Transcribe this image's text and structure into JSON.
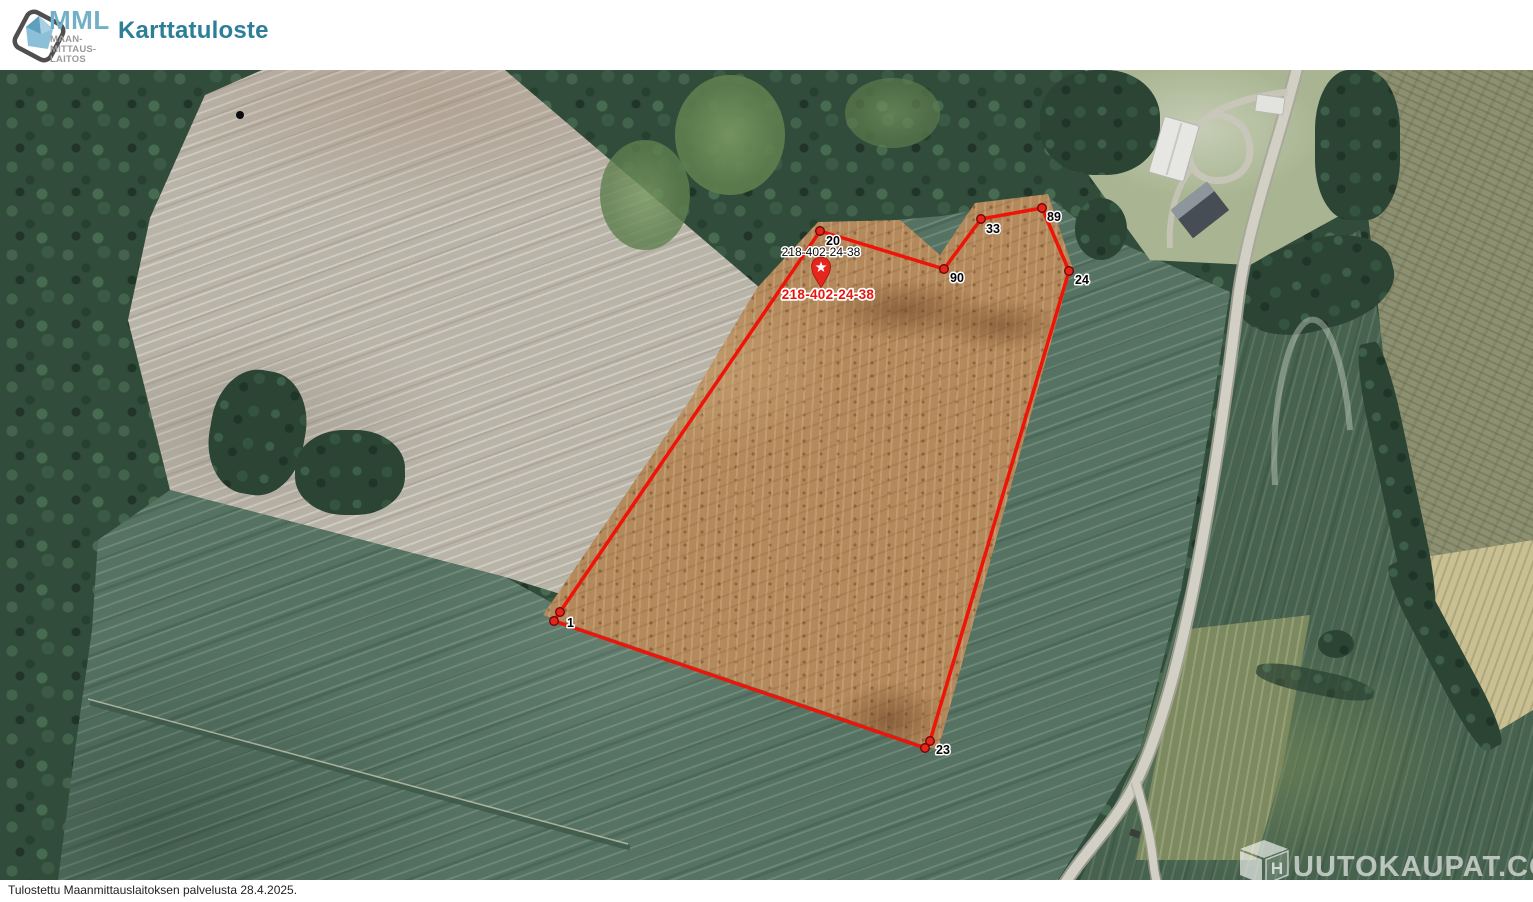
{
  "header": {
    "logo_abbr": "MML",
    "logo_lines": [
      "MAAN-",
      "MITTAUS-",
      "LAITOS"
    ],
    "title": "Karttatuloste"
  },
  "map": {
    "parcel": {
      "id_label_black": "218-402-24-38",
      "id_label_red": "218-402-24-38",
      "marker_icon": "star-pin"
    },
    "vertices": [
      {
        "label": "20"
      },
      {
        "label": "33"
      },
      {
        "label": "89"
      },
      {
        "label": "90"
      },
      {
        "label": "24"
      },
      {
        "label": "1"
      },
      {
        "label": "23"
      }
    ],
    "watermark": {
      "brand": "HUUTOKAUPAT.COM",
      "cube_letter": "H",
      "wordmark": "UUTOKAUPAT.COM"
    }
  },
  "footer": {
    "printed_note": "Tulostettu Maanmittauslaitoksen palvelusta 28.4.2025."
  },
  "colors": {
    "header_title": "#2d7e97",
    "logo_blue": "#72b0c8",
    "boundary_red": "#ee1408"
  }
}
